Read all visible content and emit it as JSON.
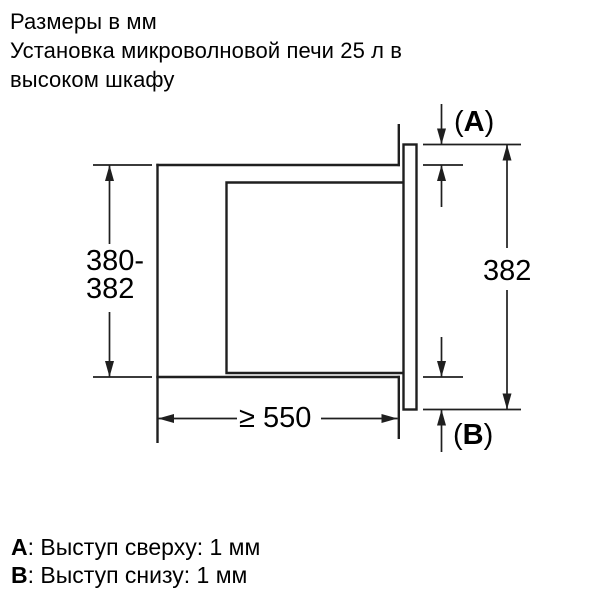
{
  "header": {
    "line1": "Размеры в мм",
    "line2": "Установка микроволновой печи 25 л в",
    "line3": "высоком шкафу"
  },
  "dimensions": {
    "niche_height_line1": "380-",
    "niche_height_line2": "382",
    "frame_height": "382",
    "niche_width": "≥ 550",
    "label_a": {
      "open": "(",
      "key": "A",
      "close": ")"
    },
    "label_b": {
      "open": "(",
      "key": "B",
      "close": ")"
    }
  },
  "legend": {
    "a_key": "A",
    "a_text": ": Выступ сверху: 1 мм",
    "b_key": "B",
    "b_text": ": Выступ снизу: 1 мм"
  },
  "colors": {
    "background": "#ffffff",
    "line": "#1f1f1f",
    "text": "#000000"
  }
}
